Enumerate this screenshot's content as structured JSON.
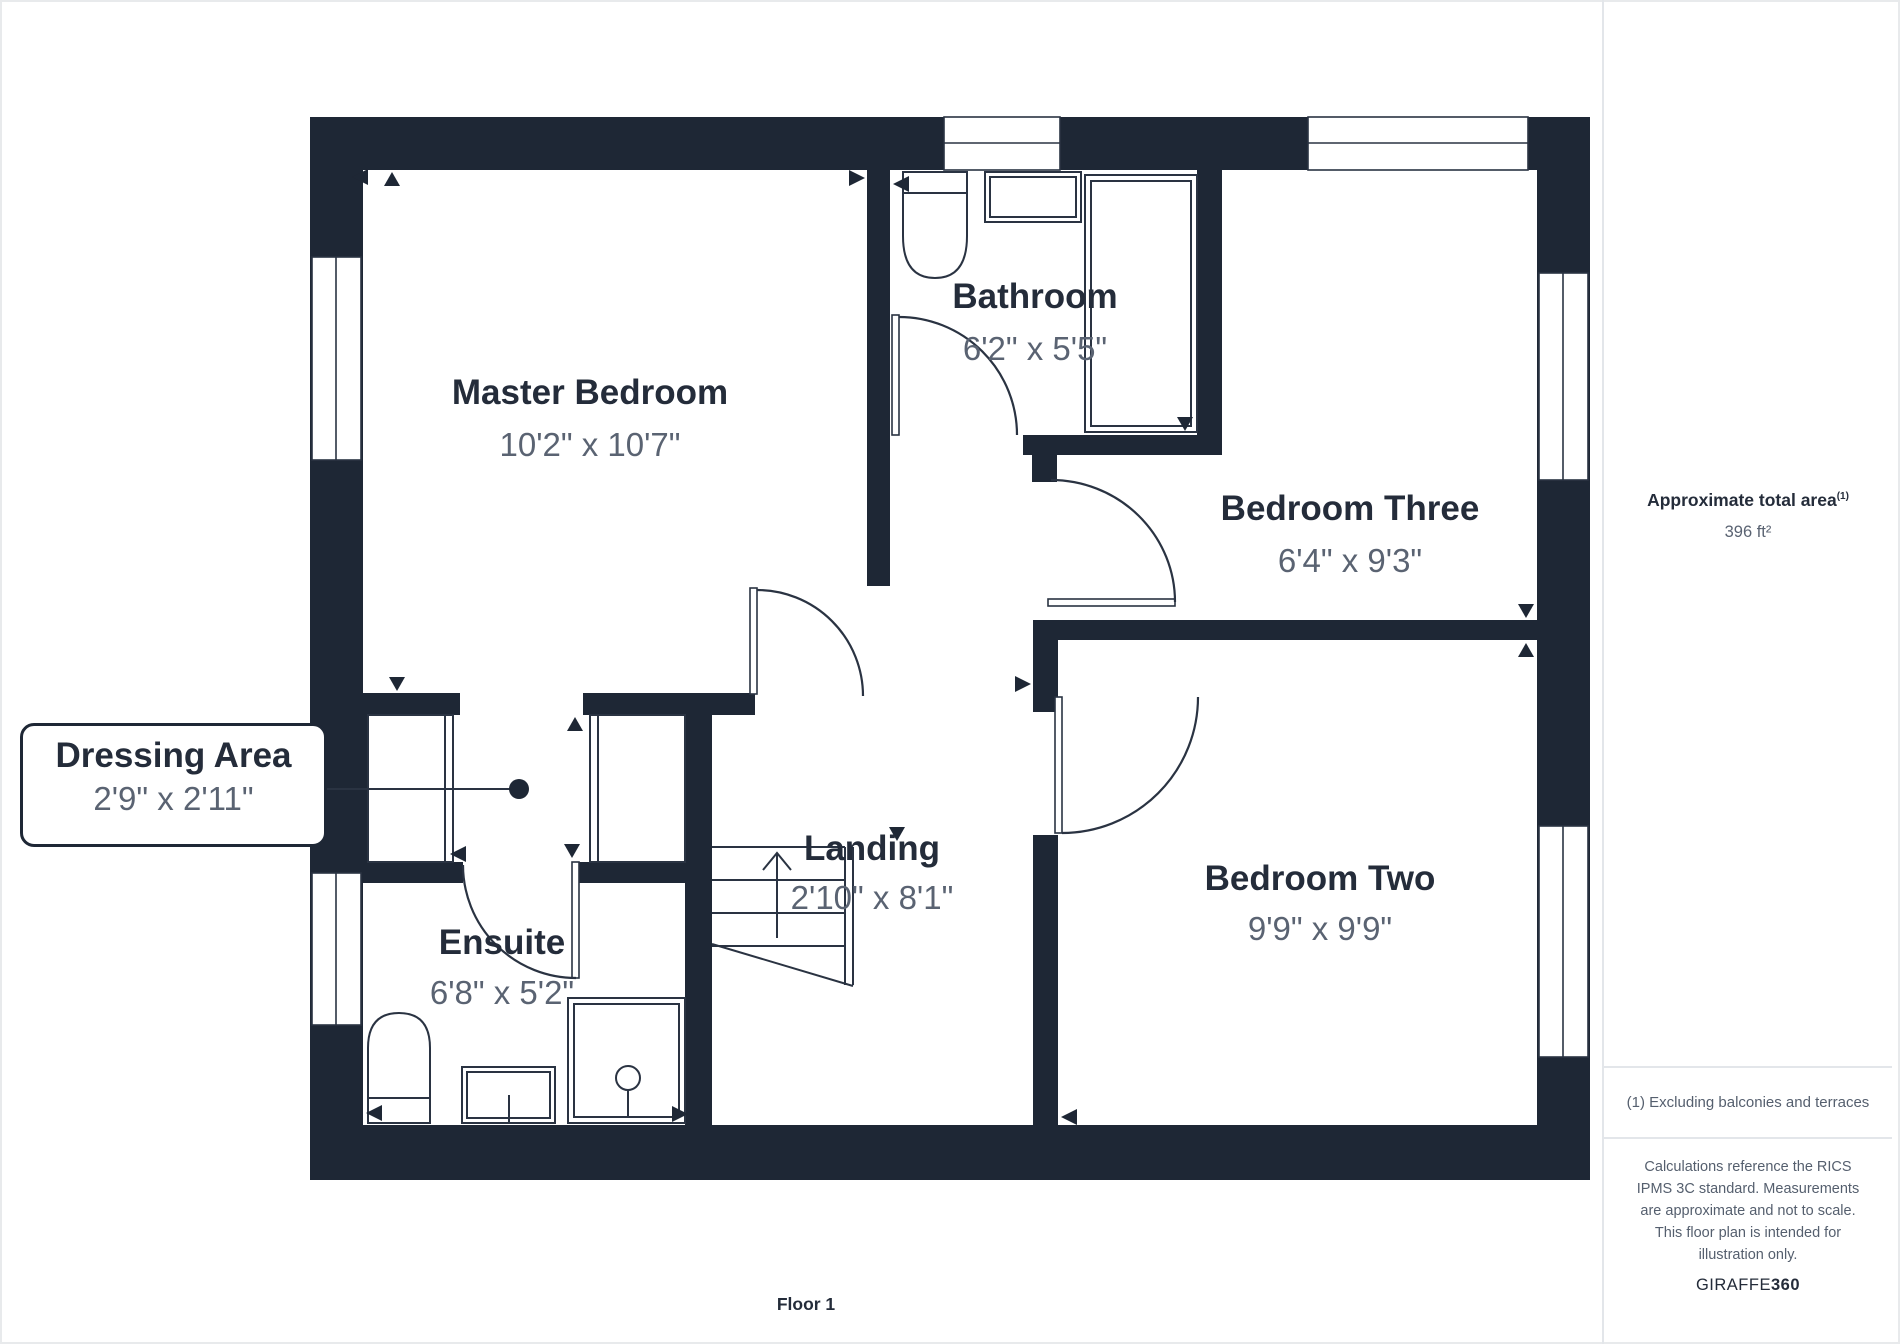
{
  "plan": {
    "rooms": {
      "master": {
        "name": "Master Bedroom",
        "dims": "10'2\" x 10'7\""
      },
      "bathroom": {
        "name": "Bathroom",
        "dims": "6'2\" x 5'5\""
      },
      "bedroom_three": {
        "name": "Bedroom Three",
        "dims": "6'4\" x 9'3\""
      },
      "bedroom_two": {
        "name": "Bedroom Two",
        "dims": "9'9\" x 9'9\""
      },
      "ensuite": {
        "name": "Ensuite",
        "dims": "6'8\" x 5'2\""
      },
      "landing": {
        "name": "Landing",
        "dims": "2'10\" x 8'1\""
      },
      "dressing": {
        "name": "Dressing Area",
        "dims": "2'9\" x 2'11\""
      }
    },
    "floor_label": "Floor 1"
  },
  "sidebar": {
    "area_title": "Approximate total area",
    "area_footnote_marker": "(1)",
    "area_value": "396 ft²",
    "footnote": "(1) Excluding balconies and terraces",
    "disclaimer": "Calculations reference the RICS IPMS 3C standard. Measurements are approximate and not to scale. This floor plan is intended for illustration only.",
    "brand_name": "GIRAFFE",
    "brand_suffix": "360"
  },
  "colors": {
    "wall": "#1e2735",
    "line": "#2a3342",
    "title_text": "#242c3a",
    "dim_text": "#5a6372",
    "divider": "#e3e6ea"
  }
}
